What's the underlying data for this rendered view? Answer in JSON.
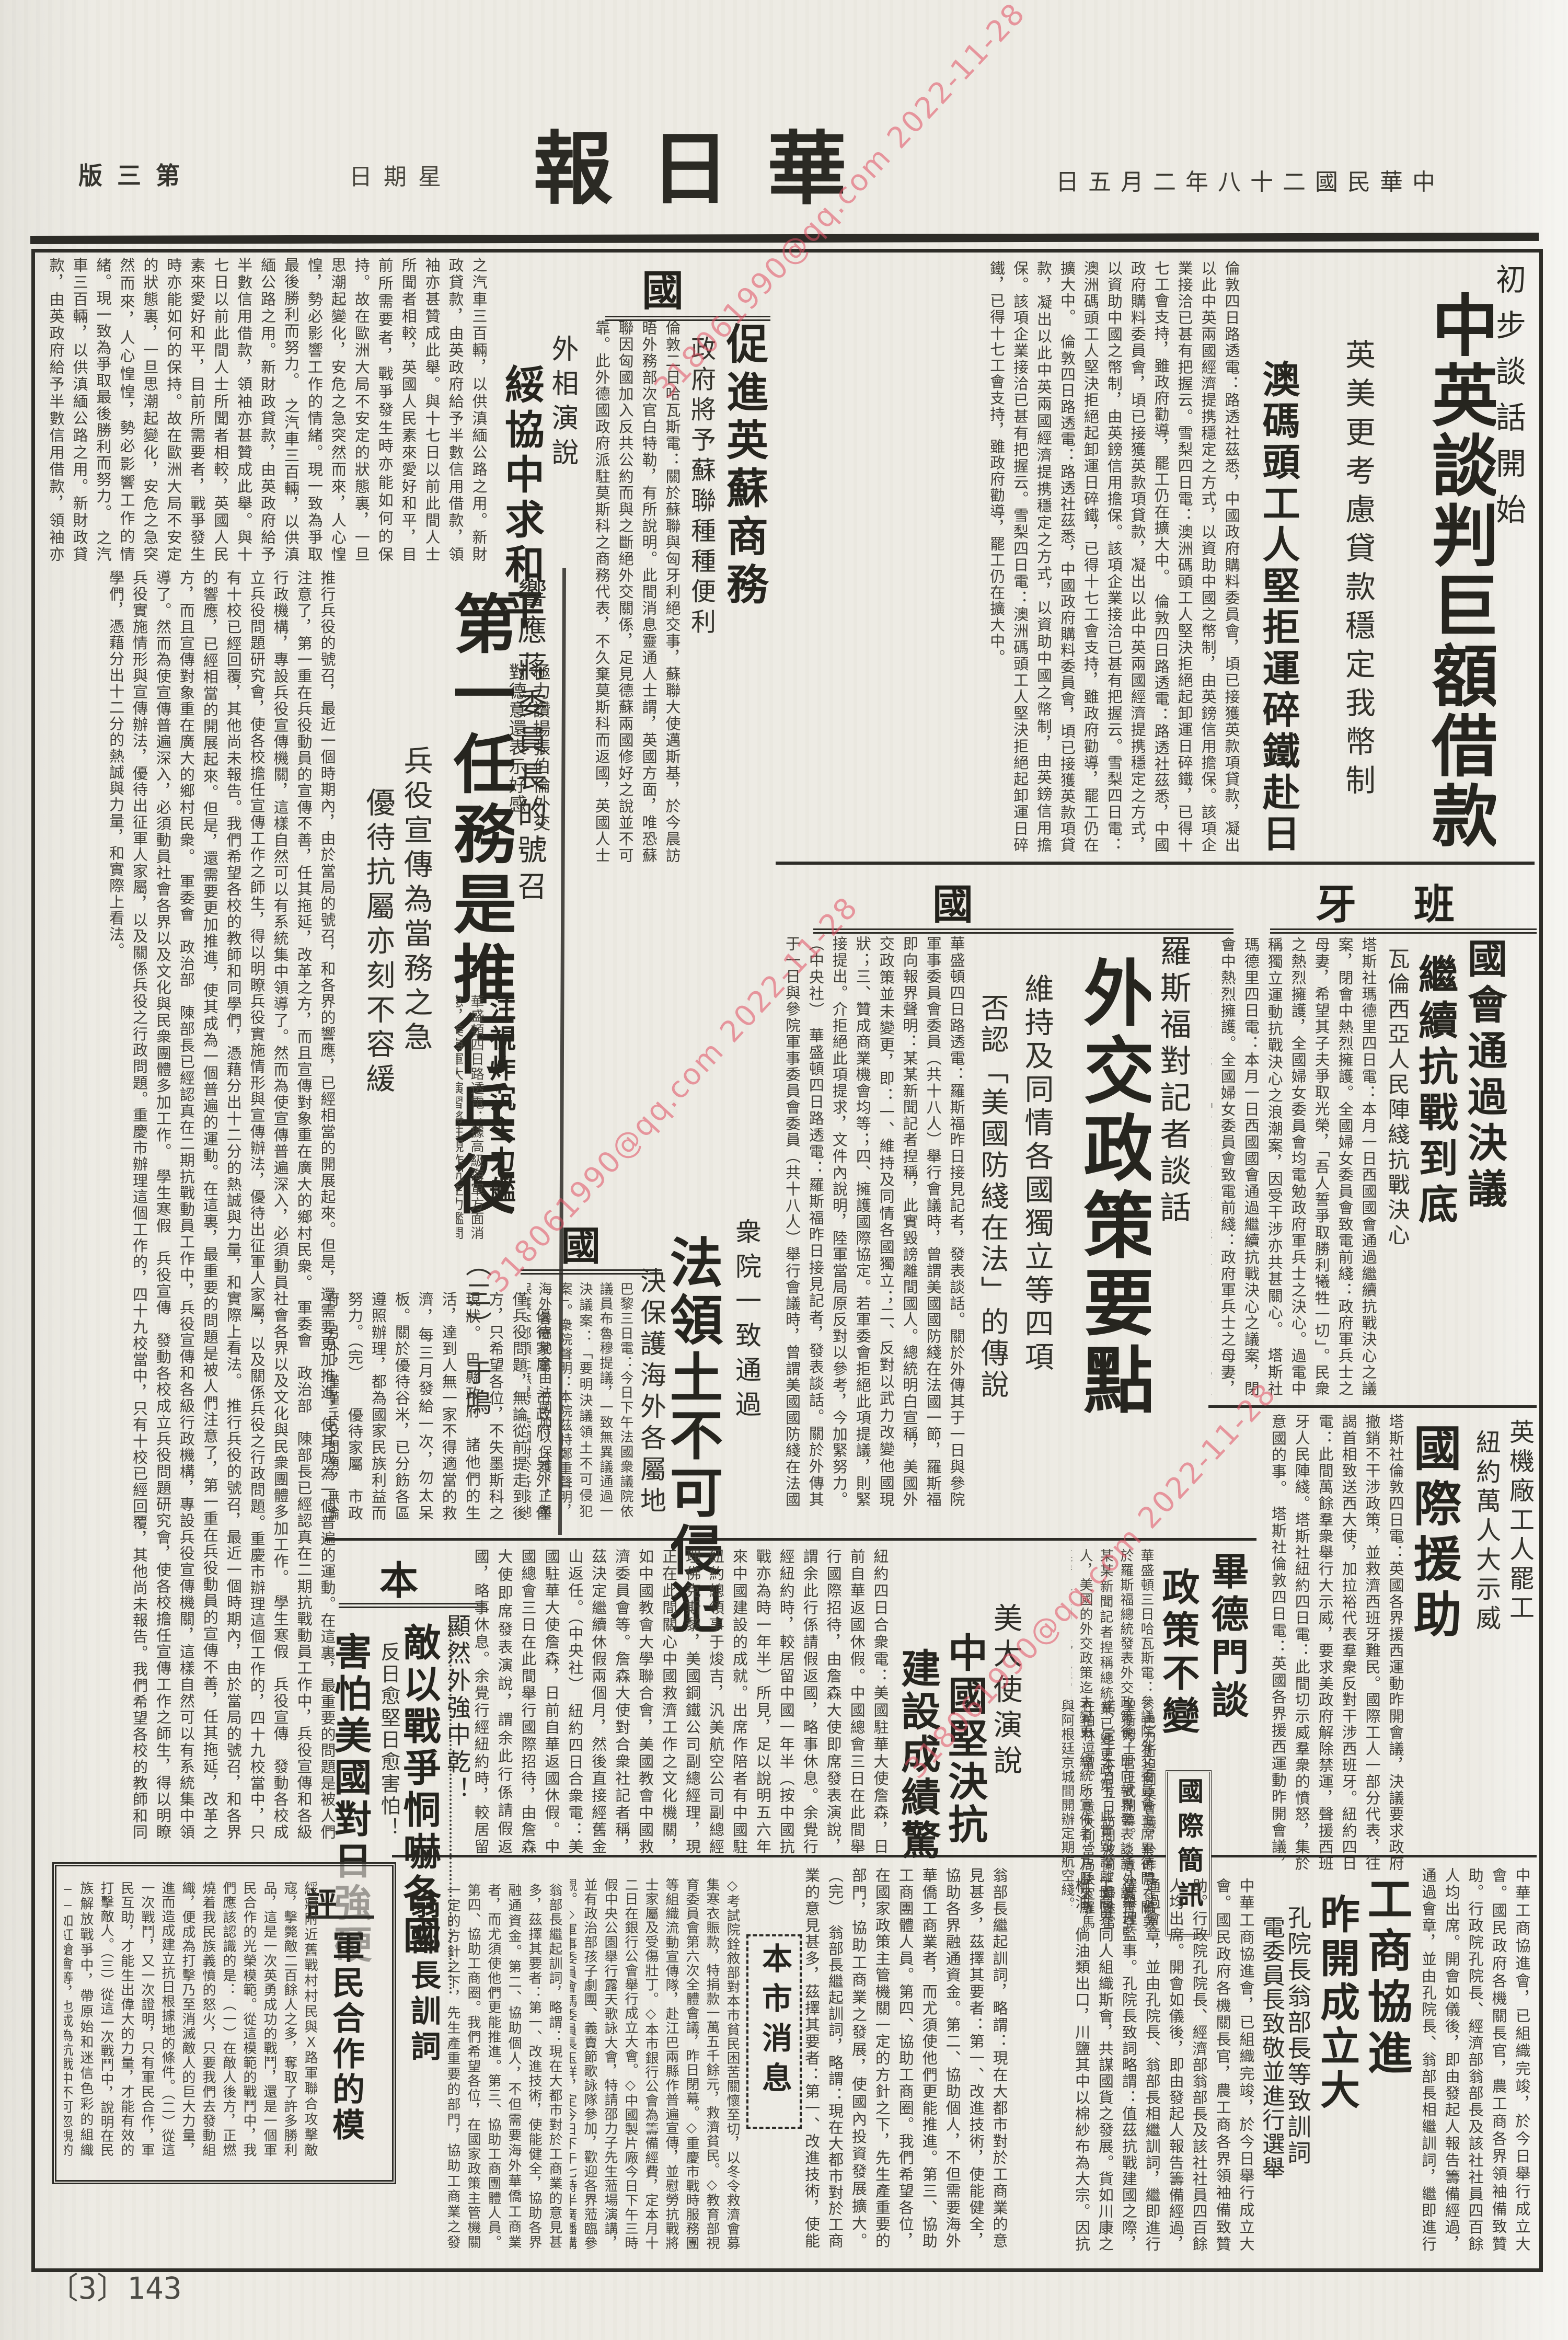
{
  "watermark": {
    "text": "318061990@qq.com 2022-11-28"
  },
  "masthead": {
    "title": "新華日報",
    "edition": "第三版",
    "weekday": "星期日",
    "date": "中華民國二十八年二月五日"
  },
  "page_number": "〔3〕143",
  "lead": {
    "kicker": "初步談話開始",
    "headline": "中英談判巨額借款",
    "sub1": "英美更考慮貸款穩定我幣制",
    "sub2": "澳碼頭工人堅拒運碎鐵赴日",
    "body": "倫敦四日路透電：路透社茲悉，中國政府購料委員會，頃已接獲英款項貸款，凝出以此中英兩國經濟提携穩定之方式，以資助中國之幣制，由英鎊信用擔保。該項企業接洽已甚有把握云。雪梨四日電：澳洲碼頭工人堅決拒絕起卸運日碎鐵，已得十七工會支持，雖政府勸導，罷工仍在擴大中。",
    "continuation": "之汽車三百輛，以供滇緬公路之用。新財政貸款，由英政府給予半數信用借款，領袖亦甚贊成此舉。與十七日以前此間人士所聞者相較，英國人民素來愛好和平，目前所需要者，戰爭發生時亦能如何的保持。故在歐洲大局不安定的狀態裏，一旦思潮起變化，安危之急突然而來，人心惶惶，勢必影響工作的情緒。現一致為爭取最後勝利而努力。"
  },
  "uk": {
    "label": "英國",
    "s1_headline": "促進英蘇商務",
    "s1_sub": "政府將予蘇聯種種便利",
    "s1_body": "倫敦二日哈瓦斯電：關於蘇聯與匈牙利絕交事，蘇聯大使邁斯基，於今晨訪晤外務部次官白特勒，有所說明。此間消息靈通人士謂，英國方面，唯恐蘇聯因匈國加入反共公約而與之斷絕外交關係，足見德蘇兩國修好之說並不可靠。此外德國政府派駐莫斯科之商務代表，不久棄莫斯科而返國，英國人士亦引以為慰。當在短時期內設法促進英蘇兩國商務關係，英政府並準備予蘇聯以種種便利。（中央社）",
    "s2_kicker": "外相演說",
    "s2_headline": "綏協中求和平",
    "s2_sub1": "極力讚揚張伯倫外交",
    "s2_sub2": "對德意還表示好感",
    "s2_body": "英國人民素來愛好和平，但於天性上自有其必要，如生命線索之貿易問題。目前希特勒氏聲明，德國亦有此需要，但英國亦將為國際間商業財政關係之均衡而努力。戰前諸國為英國最大的國際貿易之邦，此說完全不確。周屆非實，但英國亦有此期望，徹國人民關懇川口處，各國有此問題，歐戰將臨國難，黨的結果，此乃國際間商業財政關係。"
  },
  "conscription": {
    "kicker": "響應蔣委員長的號召",
    "headline": "第一任務是推行兵役",
    "sub1": "兵役宣傳為當務之急",
    "sub2": "優待抗屬亦刻不容緩",
    "author": "（三）　于鳴",
    "body1": "推行兵役的號召，最近一個時期內，由於當局的號召，和各界的響應，已經相當的開展起來。但是，還需要更加推進，使其成為一個普遍的運動。在這裏，最重要的問題是被人們注意了，第一重在兵役動員的宣傳不善，任其拖延，改革之方，而且宣傳對象重在廣大的鄉村民衆。　軍委會　政治部　陳部長已經認真在二期抗戰動員工作中，兵役宣傳和各級行政機構，專設兵役宣傳機關，這樣自然可以有系統集中領導了。然而為使宣傳普遍深入，必須動員社會各界以及文化與民衆團體多加工作。　學生寒假　兵役宣傳　發動各校成立兵役問題研究會，使各校擔任宣傳工作之師生，得以明瞭兵役實施情形與宣傳辦法，優待出征軍人家屬，以及關係兵役之行政問題。重慶市辦理這個工作的，四十九校當中，只有十校已經回覆，其他尚未報告。我們希望各校的教師和同學們，憑藉分出十二分的熱誠與力量，和實際上看法。",
    "body2": "　優待家屬　市政府　另外，僅僅兵役問題，無論從前提走到後方，只希望各位，不失墨斯科之現狀。　巴縣政府　諸他們的生活，達到人無一家不得適當的救濟，每三月發給一次，勿太呆板。關於優待谷米，已分飭各區遵照辦理，都為國家民族利益而努力。（完）"
  },
  "navy": {
    "headline": "注視炸沉主力艦",
    "body": "華盛頓四日路透電：據高級海軍方面消息，美海軍大演習將注視炸沉主力艦問題，藉以解決軍備上之重要問題。"
  },
  "us": {
    "label": "美國",
    "kicker": "羅斯福對記者談話",
    "headline": "外交政策要點",
    "sub1": "維持及同情各國獨立等四項",
    "sub2": "否認「美國防綫在法」的傳說",
    "body": "華盛頓四日路透電：羅斯福昨日接見記者，發表談話。關於外傳其于一日與參院軍事委員會委員（共十八人）舉行會議時，曾謂美國國防綫在法國一節，羅斯福即向報界聲明：某某新聞記者揑稱，此實毀謗離間國人。總統明白宣稱，美國外交政策並未變更，即：一、維持及同情各國獨立；二、反對以武力改變他國現狀；三、贊成商業機會均等；四、擁護國際協定。若軍委會拒絕此項提議，則緊接提出。介拒絕此項提求，文件內說明，陸軍當局原反對以參考，今加緊努力。（中央社）"
  },
  "spain": {
    "label": "西班牙",
    "s1_headline1": "國會通過決議",
    "s1_headline2": "繼續抗戰到底",
    "s1_sub": "瓦倫西亞人民陣綫抗戰決心",
    "s1_body": "塔斯社瑪德里四日電：本月一日西國國會通過繼續抗戰決心之議案，閉會中熱烈擁護。全國婦女委員會致電前綫：政府軍兵士之母妻，希望其子夫爭取光榮，「吾人誓爭取勝利犧牲一切」。民衆之熱烈擁護，全國婦女委員會均電勉政府軍兵士之決心。過電中稱獨立運動抗戰決心之浪潮案，因受干涉亦共甚關心。",
    "s2_sub1": "英機廠工人罷工",
    "s2_sub2": "紐約萬人大示威",
    "s2_headline": "國際援助",
    "s2_body": "塔斯社倫敦四日電：英國各界援西運動昨開會議，決議要求政府撤銷不干涉政策，並救濟西班牙難民。國際工人一部分代表，往謁首相致送西大使，加拉裕代表羣衆反對干涉西班牙。紐約四日電：此間萬餘羣衆舉行大示威，要求美政府解除禁運，聲援西班牙人民陣綫。塔斯社紐約四日電：此間切示威羣衆的憤怒，集於意國的事。"
  },
  "france": {
    "label": "法國",
    "kicker": "衆院一致通過",
    "headline": "法領土不可侵犯",
    "sub": "決保護海外各屬地",
    "body": "巴黎三日電：今日下午法國衆議院依議員布魯穆提議，一致無異議通過一決議案：「要明決議領土不可侵犯案」。衆院聲明：本院茲特鄭重聲明，海外各屬地全由法國加以保護，正與保護本部領土無異，法國對於各該地方所保有之整個的主權，未便移交他國或委任他國代為行使，或與他國共同行使之。據巴黎三日哈瓦斯電，該案內容亦同。（中央社）"
  },
  "japan": {
    "label": "日本",
    "kicker": "顯然外強中乾！",
    "headline1": "敵以戰爭恫嚇各國",
    "sub": "反日愈堅日愈害怕！",
    "headline2": "害怕美國對日強硬",
    "body": "東京三日路透電：今日國會開會時，外相有田提及在東京召集國際會議，以謀解決各國對日糾紛之可能性問題。有田又謂：日本對於美國之反日問題，有的希望日本能與英美法成立諒解，不可作無味之刺激。（中央社）"
  },
  "ambassador": {
    "kicker": "美大使演說",
    "headline1": "中國堅決抗戰",
    "headline2": "建設成績驚人",
    "body": "紐約四日合衆電：美國駐華大使詹森，日前自華返國休假。中國總會三日在此間舉行國際招待，由詹森大使即席發表演說，謂余此行係請假返國，略事休息。余覺行經紐約時，較居留中國一年半（按中國抗戰亦為時一年半）所見，足以說明五六年來中國建設的成就。出席作陪者有中國駐紐約總領事于焌吉，汎美航空公司副總經理佛克斯黎，美國鋼鐵公司副總經理，現正在此間關心中國救濟工作之文化機關，如中國教會大學聯合會，美國教會中國救濟委員會等。詹森大使對合衆社記者稱，茲決定繼續休假兩個月，然後直接經舊金山返任。（中央社）"
  },
  "biddle": {
    "headline1": "畢德門談",
    "headline2": "政策不變",
    "body": "華盛頓三日哈瓦斯電：參議院外交委員會主席畢德門，關於羅斯福總統發表外交政策後，即向報界發表談話，謂：某某新聞記者揑稱總統業已變更政策，此實毀謗離間國人，美國的外交政策迄未變更。總統所宣佈者，乃歷來所遵守之原則，此乃經常現象，無足驚奇。絕此間美國人士宣稱，不負任何責任。（中央社）戰禍弭於未然，則助成國際之均勢，自屬方法之一。因若果勢均力敵，則當無一國敢冒大不韙也。"
  },
  "briefs": {
    "label": "國際簡訊",
    "body": "◇巴力斯坦圓桌會議，於昨晨在倫敦聖衛姆士宮正式開幕。◇意外長齊亞諾，定于本月五日訪問波蘭，歸途當在柏林逗留。◇意大利當局決定羅馬與阿根廷京城間開辦定期航空綫。"
  },
  "commerce": {
    "headline1": "工商協進會",
    "headline2": "昨開成立大會",
    "sub1": "孔院長翁部長等致訓詞",
    "sub2": "電委員長致敬並進行選舉",
    "body": "中華工商協進會，已組織完竣，於今日舉行成立大會。國民政府各機關長官，農工商各界領袖備致贊助。行政院孔院長、經濟部翁部長及該社社員四百餘人均出席。開會如儀後，即由發起人報告籌備經過，通過會章，並由孔院長、翁部長相繼訓詞，繼即進行選舉理監事。孔院長致詞略謂：值茲抗戰建國之際，工商界同人組織斯會，共謀國貨之發展。貨如川康之桐油，倘油類出口，川鹽其中以棉紗布為大宗。因抗戰後重要紗織廠已有多家，紗錠達千萬餘錠，但是四川產棉並不多，而且又不敷需要，因此尚須向外省購訂，所以必須增產。"
  },
  "weng": {
    "headline": "翁部長訓詞",
    "body": "翁部長繼起訓詞，略謂：現在大都市對於工商業的意見甚多，茲擇其要者：第一、改進技術，使能健全，協助各界融通資金。第二、協助個人，不但需要海外華僑工商業者，而尤須使他們更能推進。第三、協助工商團體人員。第四、協助工商圈。我們希望各位，在國家政策主管機關一定的方針之下，先生產重要的部門，協助工商業之發展，使國內投資發展擴大。（完）"
  },
  "citynews": {
    "label": "本市消息",
    "body": "◇考試院銓敘部對本市貧民困苦關懷至切，以冬令救濟會募集寒衣賑款，特捐款一萬五千餘元，救濟貧民。◇教育部視育委員會第六次全體會議，昨日閉幕。◇重慶市戰時服務團等組織流動宣傳隊，赴江巴兩縣作普遍宣傳，並慰勞抗戰將士家屬及受傷壯丁。◇本市銀行公會為籌備經費，定本月十二日在銀行公會舉行成立大會。◇中國製片廠今日下午三時假中央公園舉行露天歌詠大會，特請邵力子先生蒞場演講，並有政治部孩子劇團、義賣節歌詠隊參加，歡迎各界蒞臨參觀。◇軍事委員會馮委員長玉祥，定今日下午七時半廣播講演，題為「抗戰新階段中我們的任務」。"
  },
  "editorial": {
    "label": "短評",
    "headline": "軍民合作的模範",
    "body": "綏寢附近舊戰村村民與Ｘ路軍聯合攻擊敵寇，擊斃敵二百餘人之多，奪取了許多勝利品，這是一次英勇成功的戰鬥，還是一個軍民合作的光榮模範。從這模範的戰鬥中，我們應該認識的是：（一）在敵人後方，正燃燒着我民族義憤的怒火，只要我們去發動組織，便成為打擊乃至消滅敵人的巨大力量，進而造成建立抗日根據地的條件。（二）從這一次戰鬥，又一次證明，只有軍民合作，軍民互助，才能生出偉大的力量，才能有效的打擊敵人。（三）從這一次戰鬥中，說明在民族解放戰爭中，帶原始和迷信色彩的組織——如紅槍會等，也成為抗戰中不可忽視的力量。（四）這一次戰鬥，我方充分的對敵情的了解，和事先週密的部署，所以能夠按照預定計劃，迅速達到殲敵目的。我們謹向為國殉亡的戰士致哀悼！我們更希望在各戰線上的戰鬥中，加強軍民合作與軍民互助的精神。"
  }
}
